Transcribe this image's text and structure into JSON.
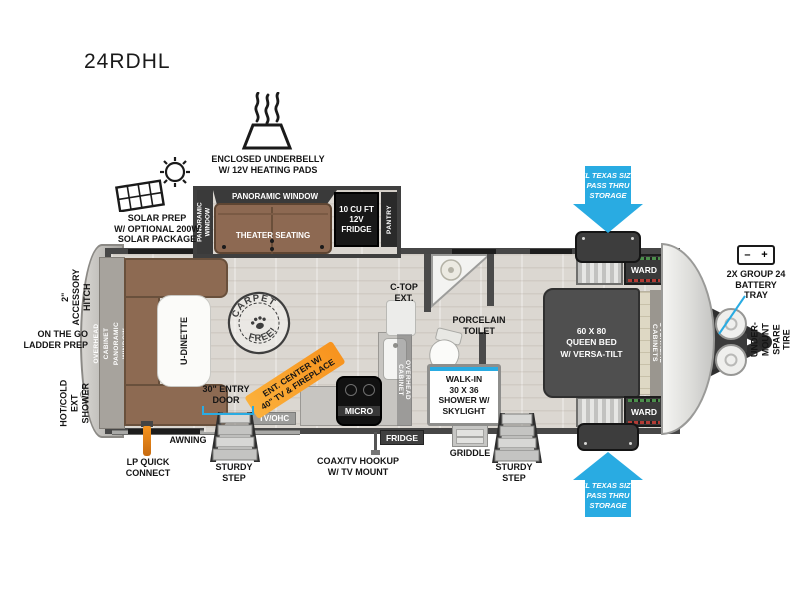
{
  "model": "24RDHL",
  "colors": {
    "accent_cyan": "#29abe2",
    "accent_orange": "#f7931e",
    "wall_gray": "#4a4a4a",
    "furniture_brown": "#8d6952",
    "bed_gray": "#4f4f4f"
  },
  "icons": [
    "heating-pads-icon",
    "solar-panel-icon",
    "carpet-free-stamp-icon",
    "battery-icon",
    "propane-tongue-icon",
    "steps-icon",
    "griddle-icon",
    "lp-connector-icon",
    "toilet-icon",
    "sink-icon",
    "shower-knob-icon",
    "coax-cable-icon",
    "arrow-down-icon",
    "arrow-up-icon"
  ],
  "exterior": {
    "underbelly": "ENCLOSED UNDERBELLY\nW/ 12V HEATING PADS",
    "solar": "SOLAR PREP\nW/ OPTIONAL 200W\nSOLAR PACKAGE",
    "pass_thru_top": "XL TEXAS SIZE\nPASS THRU\nSTORAGE",
    "pass_thru_bottom": "XL TEXAS SIZE\nPASS THRU\nSTORAGE",
    "battery_tray": "2X GROUP 24\nBATTERY\nTRAY",
    "battery_minus": "–",
    "battery_plus": "+",
    "spare_tire": "UNDER-MOUNT\nSPARE TIRE",
    "accessory_hitch": "2\" ACCESSORY\nHITCH",
    "ladder_prep": "ON THE GO\nLADDER PREP",
    "ext_shower": "HOT/COLD\nEXT SHOWER",
    "lp_quick_connect": "LP QUICK\nCONNECT",
    "awning": "AWNING",
    "sturdy_step_left": "STURDY\nSTEP",
    "sturdy_step_right": "STURDY\nSTEP",
    "entry_door": "30\" ENTRY\nDOOR",
    "coax_hookup": "COAX/TV HOOKUP\nW/ TV MOUNT",
    "griddle": "GRIDDLE"
  },
  "interior": {
    "panoramic_window_top": "PANORAMIC WINDOW",
    "panoramic_window_side": "PANORAMIC\nWINDOW",
    "theater_seating": "THEATER SEATING",
    "fridge_12v": "10 CU FT\n12V\nFRIDGE",
    "pantry": "PANTRY",
    "carpet_free_top": "CARPET",
    "carpet_free_bottom": "FREE!",
    "rear_wall": "OVERHEAD CABINET\nPANORAMIC WINDOW",
    "u_dinette": "U-DINETTE",
    "ent_center": "ENT. CENTER W/\n40\" TV & FIREPLACE",
    "tv_ohc": "TV/OHC",
    "micro": "MICRO",
    "fridge_tag": "FRIDGE",
    "c_top_ext": "C-TOP\nEXT.",
    "overhead_cabinet": "OVERHEAD CABINET",
    "porcelain_toilet": "PORCELAIN\nTOILET",
    "walk_in_shower": "WALK-IN\n30 X 36\nSHOWER W/\nSKYLIGHT",
    "queen_bed": "60 X  80\nQUEEN BED\nW/ VERSA-TILT",
    "ward_top": "WARD",
    "ward_bottom": "WARD",
    "overhead_cabinets_bedroom": "OVERHEAD CABINETS"
  }
}
